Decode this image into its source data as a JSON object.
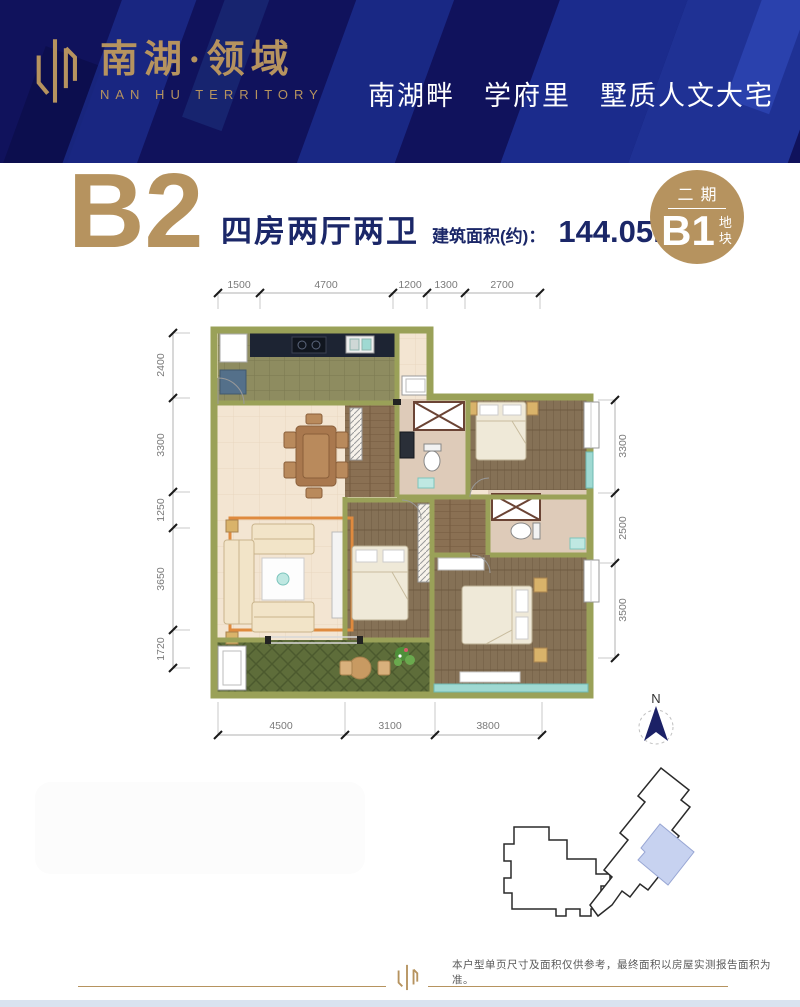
{
  "header": {
    "logo_cn": "南湖·领域",
    "logo_en": "NAN HU TERRITORY",
    "tagline": "南湖畔　学府里　墅质人文大宅"
  },
  "unit": {
    "name": "B2",
    "layout": "四房两厅两卫",
    "area_label": "建筑面积(约)：",
    "area_value": "144.05m",
    "area_exponent": "2"
  },
  "badge": {
    "phase": "二期",
    "plot": "B1",
    "plot_suffix": "地块"
  },
  "floorplan": {
    "dims_top": [
      "1500",
      "4700",
      "1200",
      "1300",
      "2700"
    ],
    "dims_left": [
      "2400",
      "3300",
      "1250",
      "3650",
      "1720"
    ],
    "dims_right": [
      "3300",
      "2500",
      "3500"
    ],
    "dims_bottom": [
      "4500",
      "3100",
      "3800"
    ]
  },
  "compass": {
    "north_label": "N"
  },
  "footer": {
    "disclaimer": "本户型单页尺寸及面积仅供参考，最终面积以房屋实测报告面积为准。"
  },
  "colors": {
    "navy_background": "#10125c",
    "gold_accent": "#b6935f",
    "wall_olive": "#9aa158",
    "site_highlight_blue": "#c7d2f0"
  }
}
